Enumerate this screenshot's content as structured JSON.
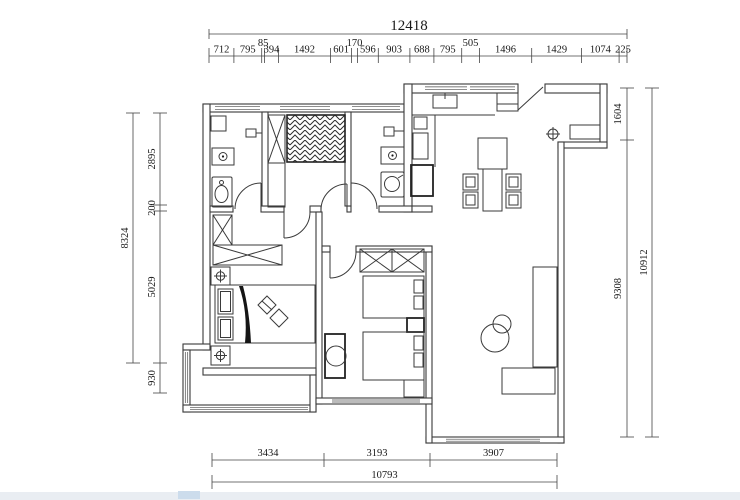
{
  "drawing_type": "apartment-floor-plan",
  "colors": {
    "line": "#3a3a3a",
    "dim_line": "#454545",
    "text": "#181818",
    "dark_fill": "#151515",
    "background": "#ffffff",
    "edge_artifact": "#e9edf2"
  },
  "dimensions": {
    "top": {
      "total": "12418",
      "row": [
        "712",
        "795",
        "85",
        "394",
        "1492",
        "601",
        "170",
        "596",
        "903",
        "688",
        "795",
        "505",
        "1496",
        "1429",
        "1074",
        "225"
      ]
    },
    "left": {
      "total": "8324",
      "row": [
        "2895",
        "200",
        "5029",
        "930"
      ]
    },
    "right": {
      "total": "10912",
      "row": [
        "1604",
        "9308"
      ]
    },
    "bottom": {
      "total": "10793",
      "row": [
        "3434",
        "3193",
        "3907"
      ]
    }
  },
  "dim_layout": {
    "top": {
      "total_line_y": 34,
      "total_ticks": [
        209,
        627
      ],
      "total_label_x": 409,
      "row_y": 56,
      "label_y": 52.5,
      "raised_y": 46,
      "ticks": [
        209,
        233.9,
        261.7,
        264.6,
        278.4,
        330.6,
        351.6,
        357.5,
        378.3,
        409.9,
        433.9,
        461.7,
        479.4,
        531.7,
        581.6,
        619.1,
        627
      ],
      "raised": [
        2,
        6,
        11
      ]
    },
    "left": {
      "line_x": 160,
      "ticks": [
        113,
        205,
        211,
        363,
        393
      ],
      "label_x": 155,
      "outer_line_x": 133,
      "outer_ticks": [
        113,
        363
      ],
      "outer_label_x": 128,
      "outer_label_cy": 238
    },
    "right": {
      "line_x": 627,
      "ticks": [
        88,
        140,
        437
      ],
      "label_x": 621,
      "outer_line_x": 652,
      "outer_ticks": [
        88,
        437
      ],
      "outer_label_x": 647,
      "outer_label_cy": 262.5
    },
    "bottom": {
      "line_y": 460,
      "ticks": [
        212,
        324,
        430,
        557
      ],
      "label_y": 456,
      "outer_line_y": 482,
      "outer_ticks": [
        212,
        557
      ],
      "outer_label_y": 478,
      "outer_label_cx": 384.5
    }
  },
  "icons": {
    "wardrobe": "x-box",
    "lamp": "circle-cross",
    "column_marker": "circle-cross",
    "hatch_bed": "herringbone-hatch"
  }
}
